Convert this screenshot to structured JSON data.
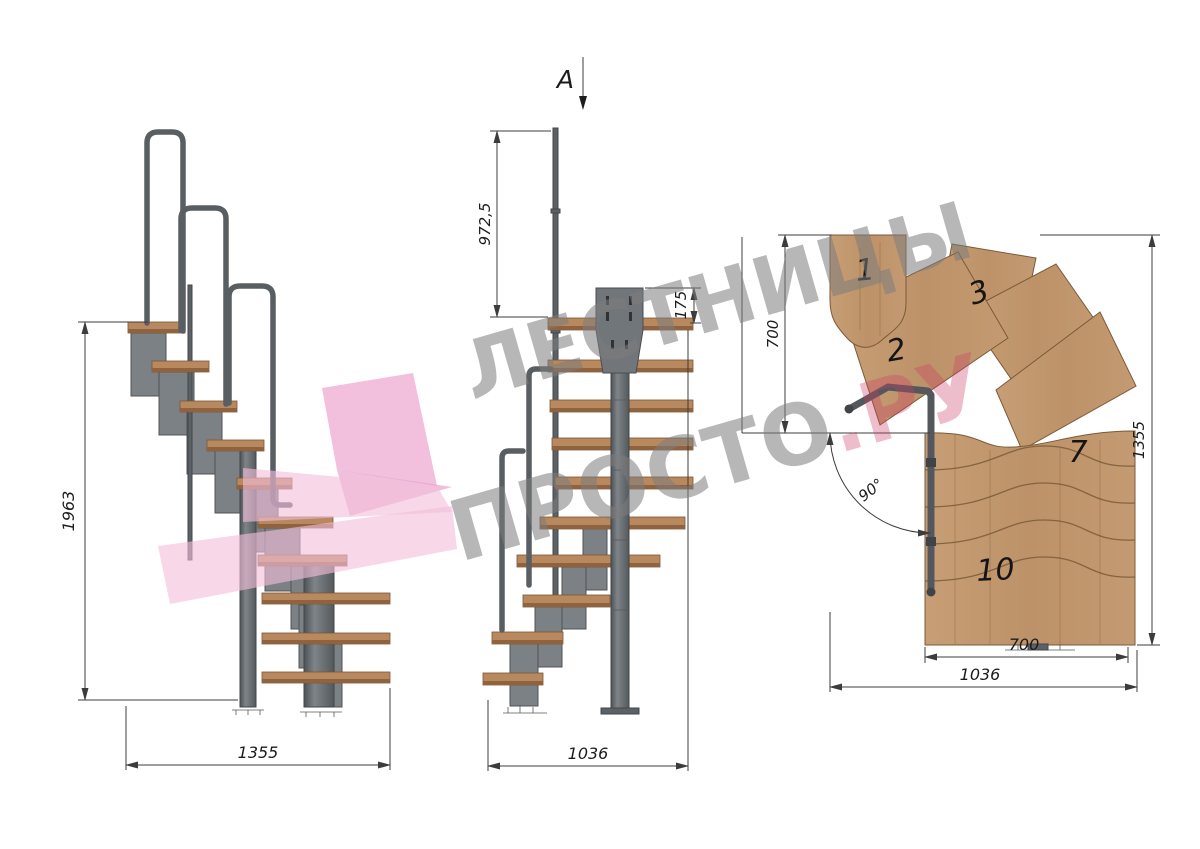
{
  "watermark": {
    "line1": "ЛЕСТНИЦЫ",
    "line2_gray": "ПРОСТО",
    "line2_accent": ".РУ",
    "gray_color": "#7d7d7d",
    "accent_color": "#cc3f66",
    "logo_pink": "#f2b9da"
  },
  "section_marker": {
    "label": "A"
  },
  "side_view": {
    "dim_total_height": "1963",
    "dim_total_depth": "1355"
  },
  "front_view": {
    "dim_rail_post_height": "972,5",
    "dim_top_bracket": "175",
    "dim_total_width": "1036"
  },
  "plan_view": {
    "dim_entry_depth": "700",
    "dim_overall_depth": "1355",
    "dim_flight_width": "700",
    "dim_overall_width": "1036",
    "dim_turn_angle": "90°",
    "tread_numbers": [
      "1",
      "2",
      "3",
      "7",
      "10"
    ]
  },
  "colors": {
    "wood": "#c2996f",
    "metal": "#70767a",
    "drafting_line": "#3c3c3c"
  }
}
